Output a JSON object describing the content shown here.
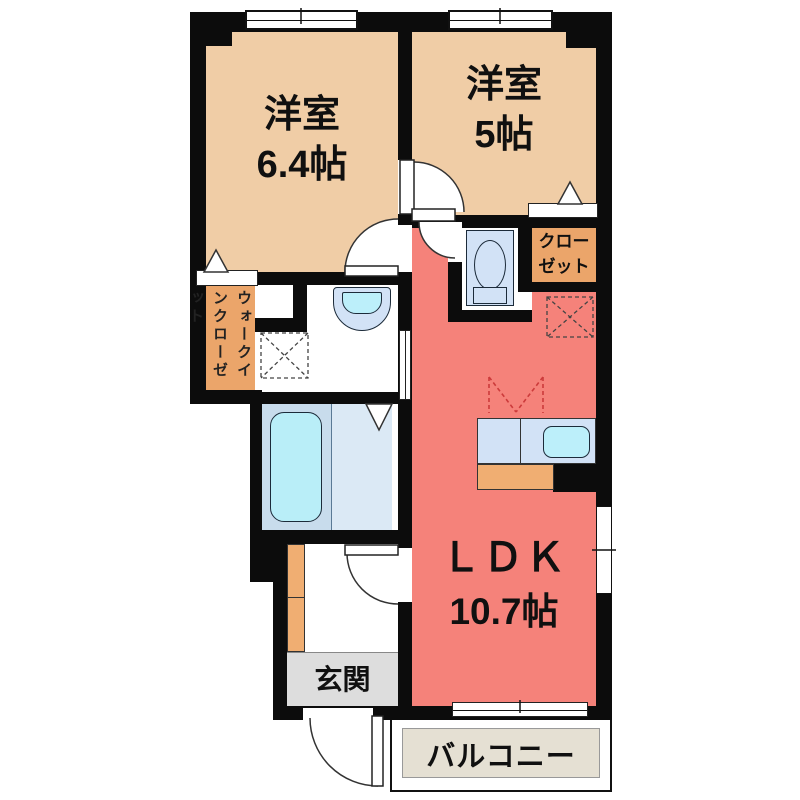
{
  "plan": {
    "rooms": {
      "bedroom1": {
        "name": "洋室",
        "size": "6.4帖"
      },
      "bedroom2": {
        "name": "洋室",
        "size": "5帖"
      },
      "closet": {
        "line1": "クロー",
        "line2": "ゼット"
      },
      "wic": {
        "line1": "ウォークイン",
        "line2": "クローゼット"
      },
      "ldk": {
        "name": "ＬＤＫ",
        "size": "10.7帖"
      },
      "entrance": {
        "name": "玄関"
      },
      "balcony": {
        "name": "バルコニー"
      }
    },
    "icons": {
      "washer_space": "dashed-x-square",
      "fridge_space": "dashed-x-square",
      "equipment_space": "dashed-v-square",
      "door_swings": "quarter-arc",
      "folding_door": "triangle"
    },
    "colors": {
      "room_peach": "#f0cda6",
      "closet_orange": "#eba56a",
      "cabinet_orange": "#f0ae72",
      "ldk_red": "#f5827a",
      "bath_left": "#c8dcec",
      "bath_right": "#dbe9f5",
      "tub_cyan": "#b9eef8",
      "fixture_blue": "#d2e2f6",
      "sink_cyan": "#bceffa",
      "entrance_gray": "#dddddd",
      "balcony_beige": "#e5e0d3",
      "wall": "#0c0c0c",
      "marker_red": "#cc3b3b"
    }
  }
}
